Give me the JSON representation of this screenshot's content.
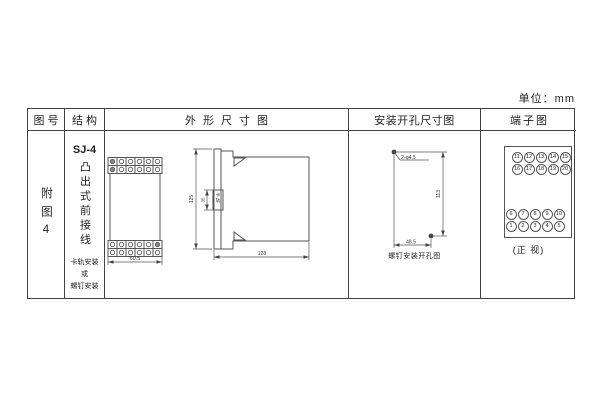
{
  "unit_label": "单位：mm",
  "table": {
    "headers": {
      "fig_no": "图号",
      "structure": "结构",
      "outline": "外形尺寸图",
      "mounting": "安装开孔尺寸图",
      "terminal": "端子图"
    }
  },
  "fig_no": "附图4",
  "structure": {
    "model": "SJ-4",
    "type": "凸出式前接线",
    "note": "卡轨安装\n或\n螺钉安装"
  },
  "outline": {
    "front_width": "60.5",
    "height": "125",
    "rail_dim": "35",
    "rail_label": "卡轨",
    "depth": "128"
  },
  "mounting": {
    "holes_label": "2-φ4.5",
    "vertical_dim": "113",
    "horizontal_dim": "48.5",
    "caption": "螺钉安装开孔图"
  },
  "terminal": {
    "top_rows": [
      [
        "11",
        "12",
        "13",
        "14",
        "15"
      ],
      [
        "16",
        "17",
        "18",
        "19",
        "20"
      ]
    ],
    "bottom_rows": [
      [
        "6",
        "7",
        "8",
        "9",
        "10"
      ],
      [
        "1",
        "2",
        "3",
        "4",
        "5"
      ]
    ],
    "caption": "(正 视)"
  }
}
